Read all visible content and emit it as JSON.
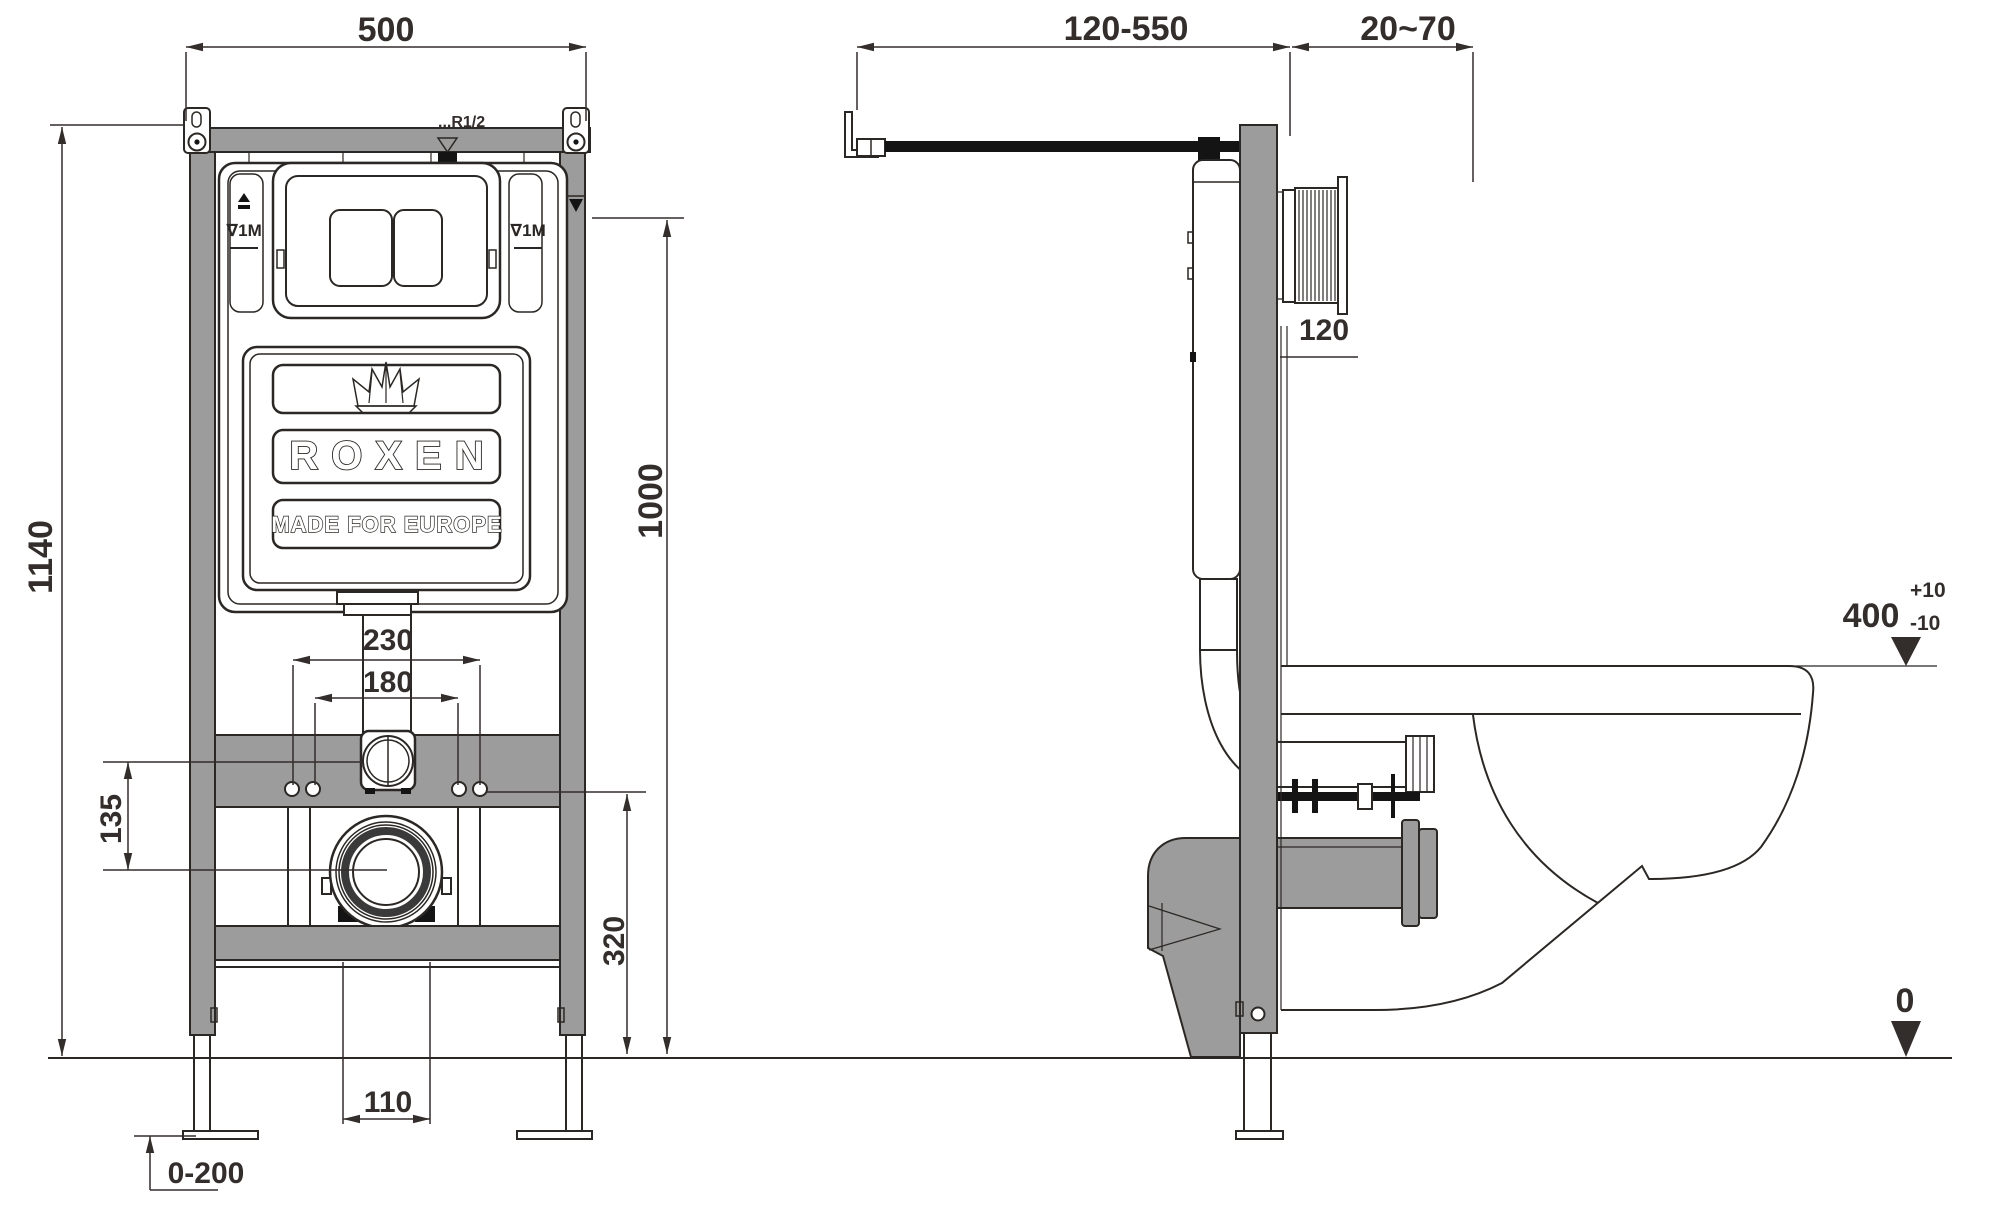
{
  "colors": {
    "frame-gray": "#9c9c9c",
    "line-dark": "#2b2724",
    "text-dark": "#332d2b",
    "black": "#141414"
  },
  "front_view": {
    "dim_width_top": "500",
    "dim_total_height": "1140",
    "dim_height_flush_axis": "1000",
    "dim_height_drain_axis": "320",
    "dim_studs_outer": "230",
    "dim_studs_inner": "180",
    "dim_axis_offset": "135",
    "dim_outlet_width": "110",
    "dim_leg_adjust_range": "0-200",
    "label_water_supply": "...R1/2",
    "label_level_left": "∇1M",
    "label_level_right": "∇1M",
    "brand": "ROXEN",
    "brand_sub": "MADE FOR EUROPE"
  },
  "side_view": {
    "dim_supply_reach": "120-550",
    "dim_wall_finish_range": "20~70",
    "dim_frame_depth": "120",
    "dim_bowl_height": "400",
    "dim_bowl_tol_plus": "+10",
    "dim_bowl_tol_minus": "-10",
    "dim_floor_level": "0"
  }
}
